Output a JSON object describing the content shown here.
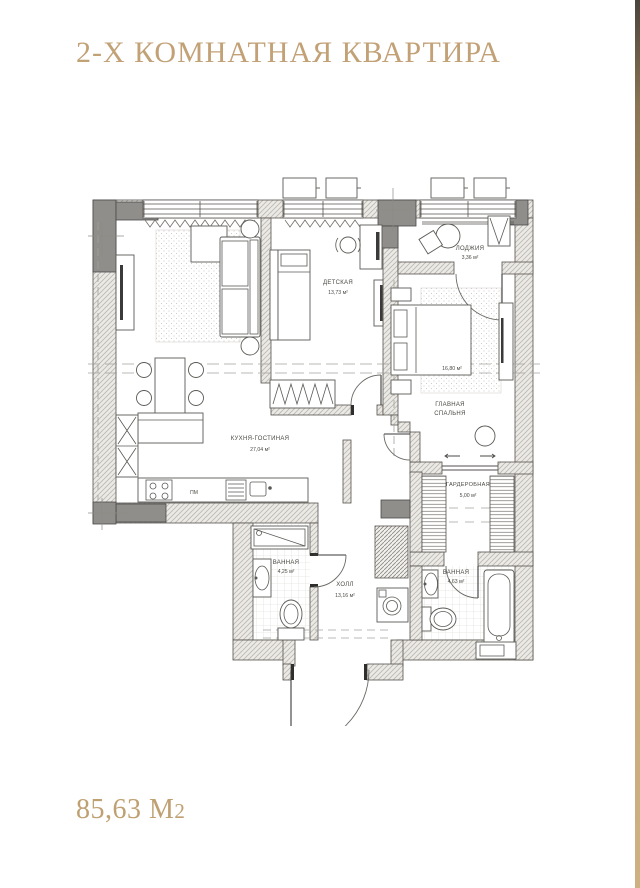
{
  "header": {
    "title": "2-Х КОМНАТНАЯ КВАРТИРА"
  },
  "footer": {
    "area_value": "85,63 М",
    "area_exp": "2"
  },
  "plan": {
    "rooms": {
      "kids": {
        "name": "ДЕТСКАЯ",
        "area": "13,73 м²"
      },
      "loggia": {
        "name": "ЛОДЖИЯ",
        "area": "3,36 м²"
      },
      "bedroom": {
        "name1": "ГЛАВНАЯ",
        "name2": "СПАЛЬНЯ",
        "area": "16,80 м²"
      },
      "kitchen_living": {
        "name": "КУХНЯ-ГОСТИНАЯ",
        "area": "27,04 м²"
      },
      "wardrobe": {
        "name": "ГАРДЕРОБНАЯ",
        "area": "5,00 м²"
      },
      "bath_left": {
        "name": "ВАННАЯ",
        "area": "4,25 м²"
      },
      "hall": {
        "name": "ХОЛЛ",
        "area": "13,16 м²"
      },
      "bath_right": {
        "name": "ВАННАЯ",
        "area": "4,63 м²"
      }
    },
    "labels": {
      "dishwasher": "ПМ"
    }
  },
  "colors": {
    "accent": "#c2a176",
    "plan_line": "#55524d"
  }
}
